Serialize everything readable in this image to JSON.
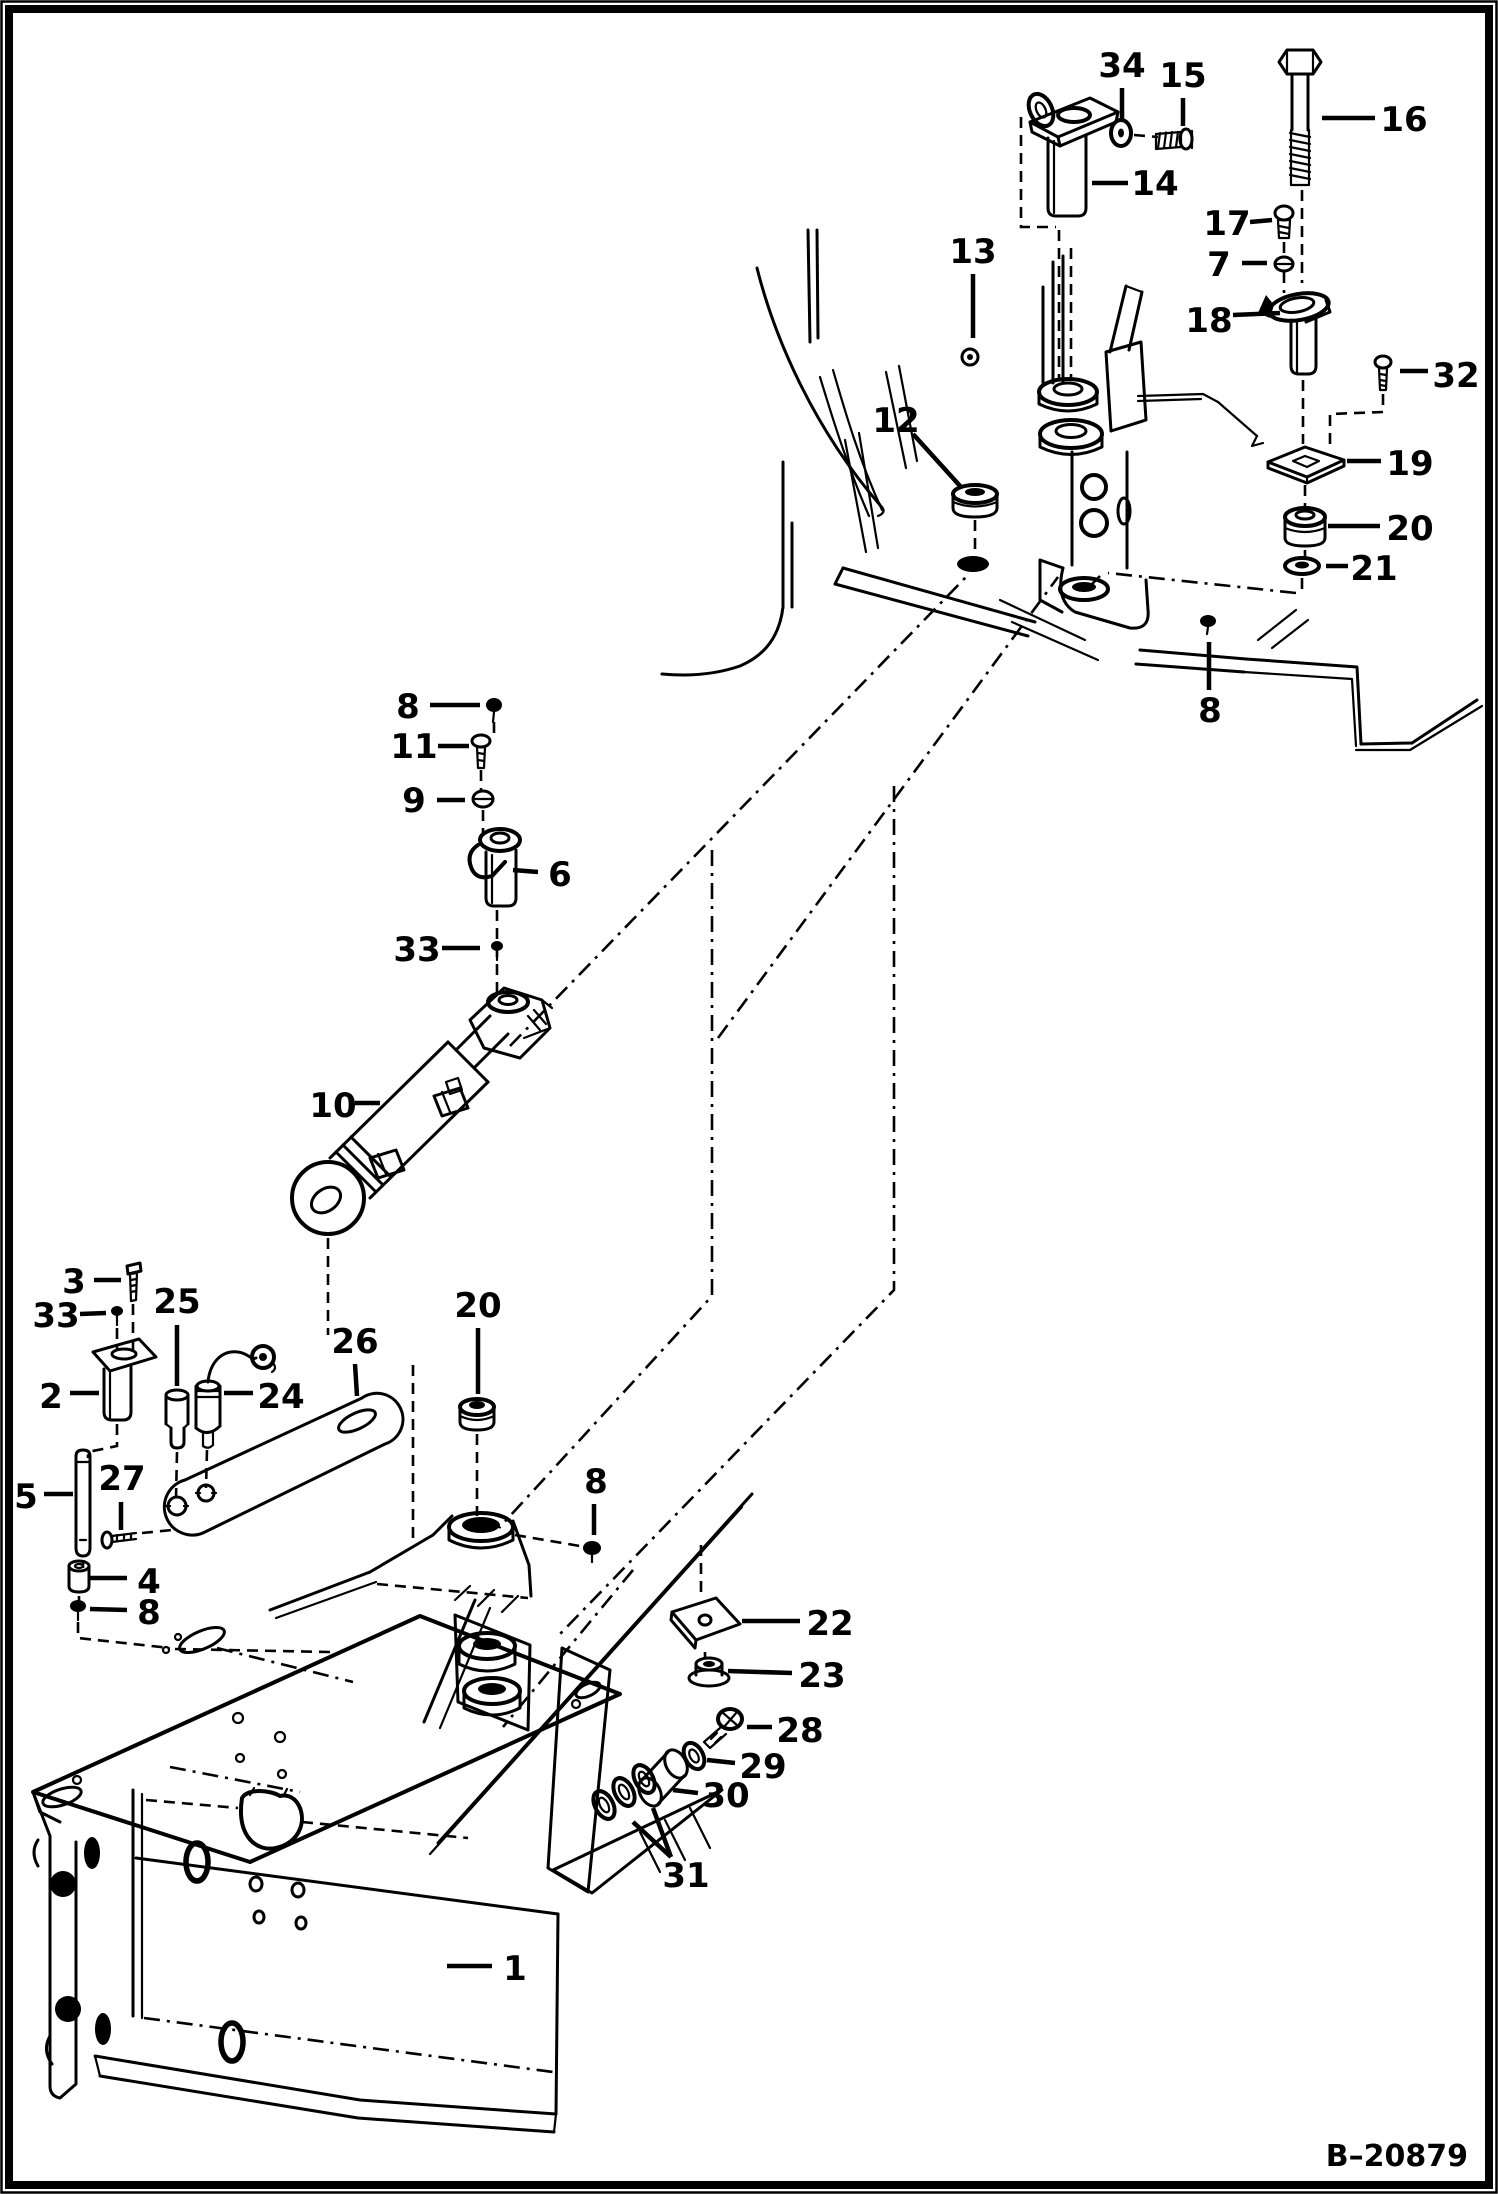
{
  "figure": {
    "ref_code": "B–20879",
    "background": "#ffffff",
    "ink": "#000000"
  },
  "callouts": [
    {
      "label": "34",
      "x": 1122,
      "y": 66,
      "leaders": [
        [
          [
            1122,
            88
          ],
          [
            1122,
            122
          ]
        ]
      ]
    },
    {
      "label": "15",
      "x": 1183,
      "y": 76,
      "leaders": [
        [
          [
            1183,
            98
          ],
          [
            1183,
            126
          ]
        ]
      ]
    },
    {
      "label": "16",
      "x": 1404,
      "y": 120,
      "leaders": [
        [
          [
            1375,
            118
          ],
          [
            1322,
            118
          ]
        ]
      ]
    },
    {
      "label": "14",
      "x": 1155,
      "y": 184,
      "leaders": [
        [
          [
            1128,
            183
          ],
          [
            1092,
            183
          ]
        ]
      ]
    },
    {
      "label": "17",
      "x": 1227,
      "y": 224,
      "leaders": [
        [
          [
            1250,
            222
          ],
          [
            1272,
            220
          ]
        ]
      ]
    },
    {
      "label": "7",
      "x": 1219,
      "y": 265,
      "leaders": [
        [
          [
            1242,
            263
          ],
          [
            1267,
            263
          ]
        ]
      ]
    },
    {
      "label": "13",
      "x": 973,
      "y": 252,
      "leaders": [
        [
          [
            973,
            274
          ],
          [
            973,
            338
          ]
        ]
      ]
    },
    {
      "label": "18",
      "x": 1209,
      "y": 321,
      "leaders": [
        [
          [
            1233,
            315
          ],
          [
            1280,
            313
          ]
        ]
      ]
    },
    {
      "label": "32",
      "x": 1456,
      "y": 376,
      "leaders": [
        [
          [
            1428,
            371
          ],
          [
            1400,
            371
          ]
        ]
      ]
    },
    {
      "label": "12",
      "x": 896,
      "y": 421,
      "leaders": [
        [
          [
            913,
            434
          ],
          [
            961,
            487
          ]
        ]
      ]
    },
    {
      "label": "19",
      "x": 1410,
      "y": 464,
      "leaders": [
        [
          [
            1381,
            461
          ],
          [
            1347,
            461
          ]
        ]
      ]
    },
    {
      "label": "20",
      "x": 1410,
      "y": 529,
      "leaders": [
        [
          [
            1380,
            526
          ],
          [
            1328,
            526
          ]
        ]
      ]
    },
    {
      "label": "21",
      "x": 1374,
      "y": 569,
      "leaders": [
        [
          [
            1348,
            566
          ],
          [
            1326,
            566
          ]
        ]
      ]
    },
    {
      "label": "8",
      "x": 1210,
      "y": 711,
      "leaders": [
        [
          [
            1209,
            690
          ],
          [
            1209,
            642
          ]
        ]
      ]
    },
    {
      "label": "8",
      "x": 408,
      "y": 707,
      "leaders": [
        [
          [
            430,
            705
          ],
          [
            480,
            705
          ]
        ]
      ]
    },
    {
      "label": "11",
      "x": 414,
      "y": 747,
      "leaders": [
        [
          [
            438,
            746
          ],
          [
            469,
            746
          ]
        ]
      ]
    },
    {
      "label": "9",
      "x": 414,
      "y": 801,
      "leaders": [
        [
          [
            437,
            800
          ],
          [
            465,
            800
          ]
        ]
      ]
    },
    {
      "label": "6",
      "x": 560,
      "y": 875,
      "leaders": [
        [
          [
            538,
            872
          ],
          [
            513,
            870
          ]
        ]
      ]
    },
    {
      "label": "33",
      "x": 417,
      "y": 950,
      "leaders": [
        [
          [
            442,
            948
          ],
          [
            480,
            948
          ]
        ]
      ]
    },
    {
      "label": "10",
      "x": 333,
      "y": 1106,
      "leaders": [
        [
          [
            355,
            1103
          ],
          [
            380,
            1103
          ]
        ]
      ]
    },
    {
      "label": "3",
      "x": 74,
      "y": 1282,
      "leaders": [
        [
          [
            94,
            1280
          ],
          [
            121,
            1280
          ]
        ]
      ]
    },
    {
      "label": "33",
      "x": 56,
      "y": 1316,
      "leaders": [
        [
          [
            80,
            1314
          ],
          [
            106,
            1313
          ]
        ]
      ]
    },
    {
      "label": "25",
      "x": 177,
      "y": 1302,
      "leaders": [
        [
          [
            177,
            1325
          ],
          [
            177,
            1386
          ]
        ]
      ]
    },
    {
      "label": "26",
      "x": 355,
      "y": 1342,
      "leaders": [
        [
          [
            355,
            1364
          ],
          [
            357,
            1396
          ]
        ]
      ]
    },
    {
      "label": "20",
      "x": 478,
      "y": 1306,
      "leaders": [
        [
          [
            478,
            1328
          ],
          [
            478,
            1394
          ]
        ]
      ]
    },
    {
      "label": "2",
      "x": 51,
      "y": 1397,
      "leaders": [
        [
          [
            70,
            1393
          ],
          [
            99,
            1393
          ]
        ]
      ]
    },
    {
      "label": "24",
      "x": 281,
      "y": 1397,
      "leaders": [
        [
          [
            253,
            1393
          ],
          [
            224,
            1393
          ]
        ]
      ]
    },
    {
      "label": "5",
      "x": 26,
      "y": 1497,
      "leaders": [
        [
          [
            44,
            1494
          ],
          [
            73,
            1494
          ]
        ]
      ]
    },
    {
      "label": "27",
      "x": 122,
      "y": 1479,
      "leaders": [
        [
          [
            121,
            1502
          ],
          [
            121,
            1530
          ]
        ]
      ]
    },
    {
      "label": "8",
      "x": 596,
      "y": 1482,
      "leaders": [
        [
          [
            594,
            1504
          ],
          [
            594,
            1535
          ]
        ]
      ]
    },
    {
      "label": "4",
      "x": 149,
      "y": 1582,
      "leaders": [
        [
          [
            127,
            1578
          ],
          [
            90,
            1578
          ]
        ]
      ]
    },
    {
      "label": "8",
      "x": 149,
      "y": 1613,
      "leaders": [
        [
          [
            127,
            1610
          ],
          [
            90,
            1609
          ]
        ]
      ]
    },
    {
      "label": "22",
      "x": 830,
      "y": 1624,
      "leaders": [
        [
          [
            800,
            1621
          ],
          [
            742,
            1621
          ]
        ]
      ]
    },
    {
      "label": "23",
      "x": 822,
      "y": 1676,
      "leaders": [
        [
          [
            792,
            1673
          ],
          [
            728,
            1671
          ]
        ]
      ]
    },
    {
      "label": "28",
      "x": 800,
      "y": 1731,
      "leaders": [
        [
          [
            772,
            1727
          ],
          [
            747,
            1727
          ]
        ]
      ]
    },
    {
      "label": "29",
      "x": 763,
      "y": 1767,
      "leaders": [
        [
          [
            735,
            1763
          ],
          [
            707,
            1760
          ]
        ]
      ]
    },
    {
      "label": "30",
      "x": 726,
      "y": 1796,
      "leaders": [
        [
          [
            698,
            1793
          ],
          [
            673,
            1790
          ]
        ]
      ]
    },
    {
      "label": "31",
      "x": 686,
      "y": 1876,
      "leaders": [
        [
          [
            633,
            1822
          ],
          [
            671,
            1857
          ]
        ],
        [
          [
            653,
            1808
          ],
          [
            671,
            1857
          ]
        ]
      ]
    },
    {
      "label": "1",
      "x": 515,
      "y": 1969,
      "leaders": [
        [
          [
            492,
            1966
          ],
          [
            447,
            1966
          ]
        ]
      ]
    }
  ]
}
